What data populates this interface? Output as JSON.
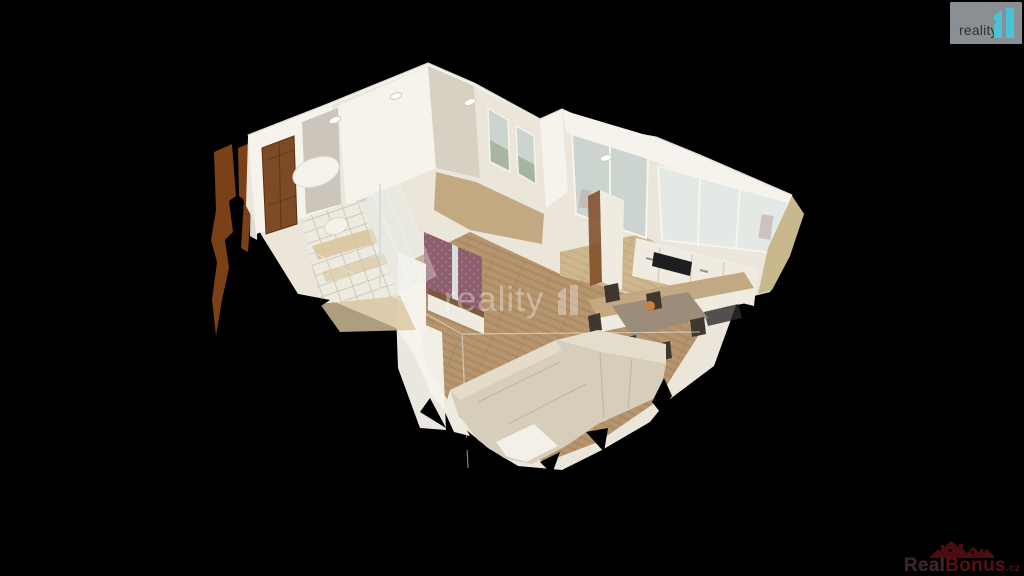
{
  "app": {
    "background": "#000000"
  },
  "branding": {
    "corner_logo": {
      "label": "reality",
      "box_color": "#8a8f94",
      "text_color": "#2e3237",
      "icon": "reality-bars-icon",
      "icon_color": "#49c3d5"
    },
    "floor_watermark": {
      "label": "reality",
      "icon": "reality-bars-icon",
      "color": "#ffffff"
    },
    "realbonus_logo": {
      "real": "Real",
      "bonus": "Bonus",
      "tld": ".cz",
      "red": "#551114",
      "dark_letter": "#342a2c",
      "icon": "houses-roofline-icon"
    }
  },
  "scene": {
    "colors": {
      "wall_light": "#f6f3ec",
      "wall_mid": "#ebe5da",
      "wall_shadow": "#d7d0c3",
      "floor_wood": "#b4936c",
      "floor_light": "#cdb68c",
      "tile_white": "#edeadf",
      "tile_beige": "#d9c6a0",
      "door_wood": "#7c4a25",
      "accent_wall": "#8d5e6e",
      "sofa": "#d6cdba",
      "sofa_light": "#e5ddcb",
      "table_wood": "#9b8d79",
      "chair_dark": "#3d372f",
      "window_view": "#ccd4d0",
      "window_green": "#8fa083",
      "cooktop": "#1d1e1f",
      "cabinet_white": "#efebe1",
      "island_wood": "#c3a981",
      "scan_brown": "#7a4018",
      "beige_ragged": "#c9b88e",
      "marble": "#ccc5bc"
    }
  }
}
